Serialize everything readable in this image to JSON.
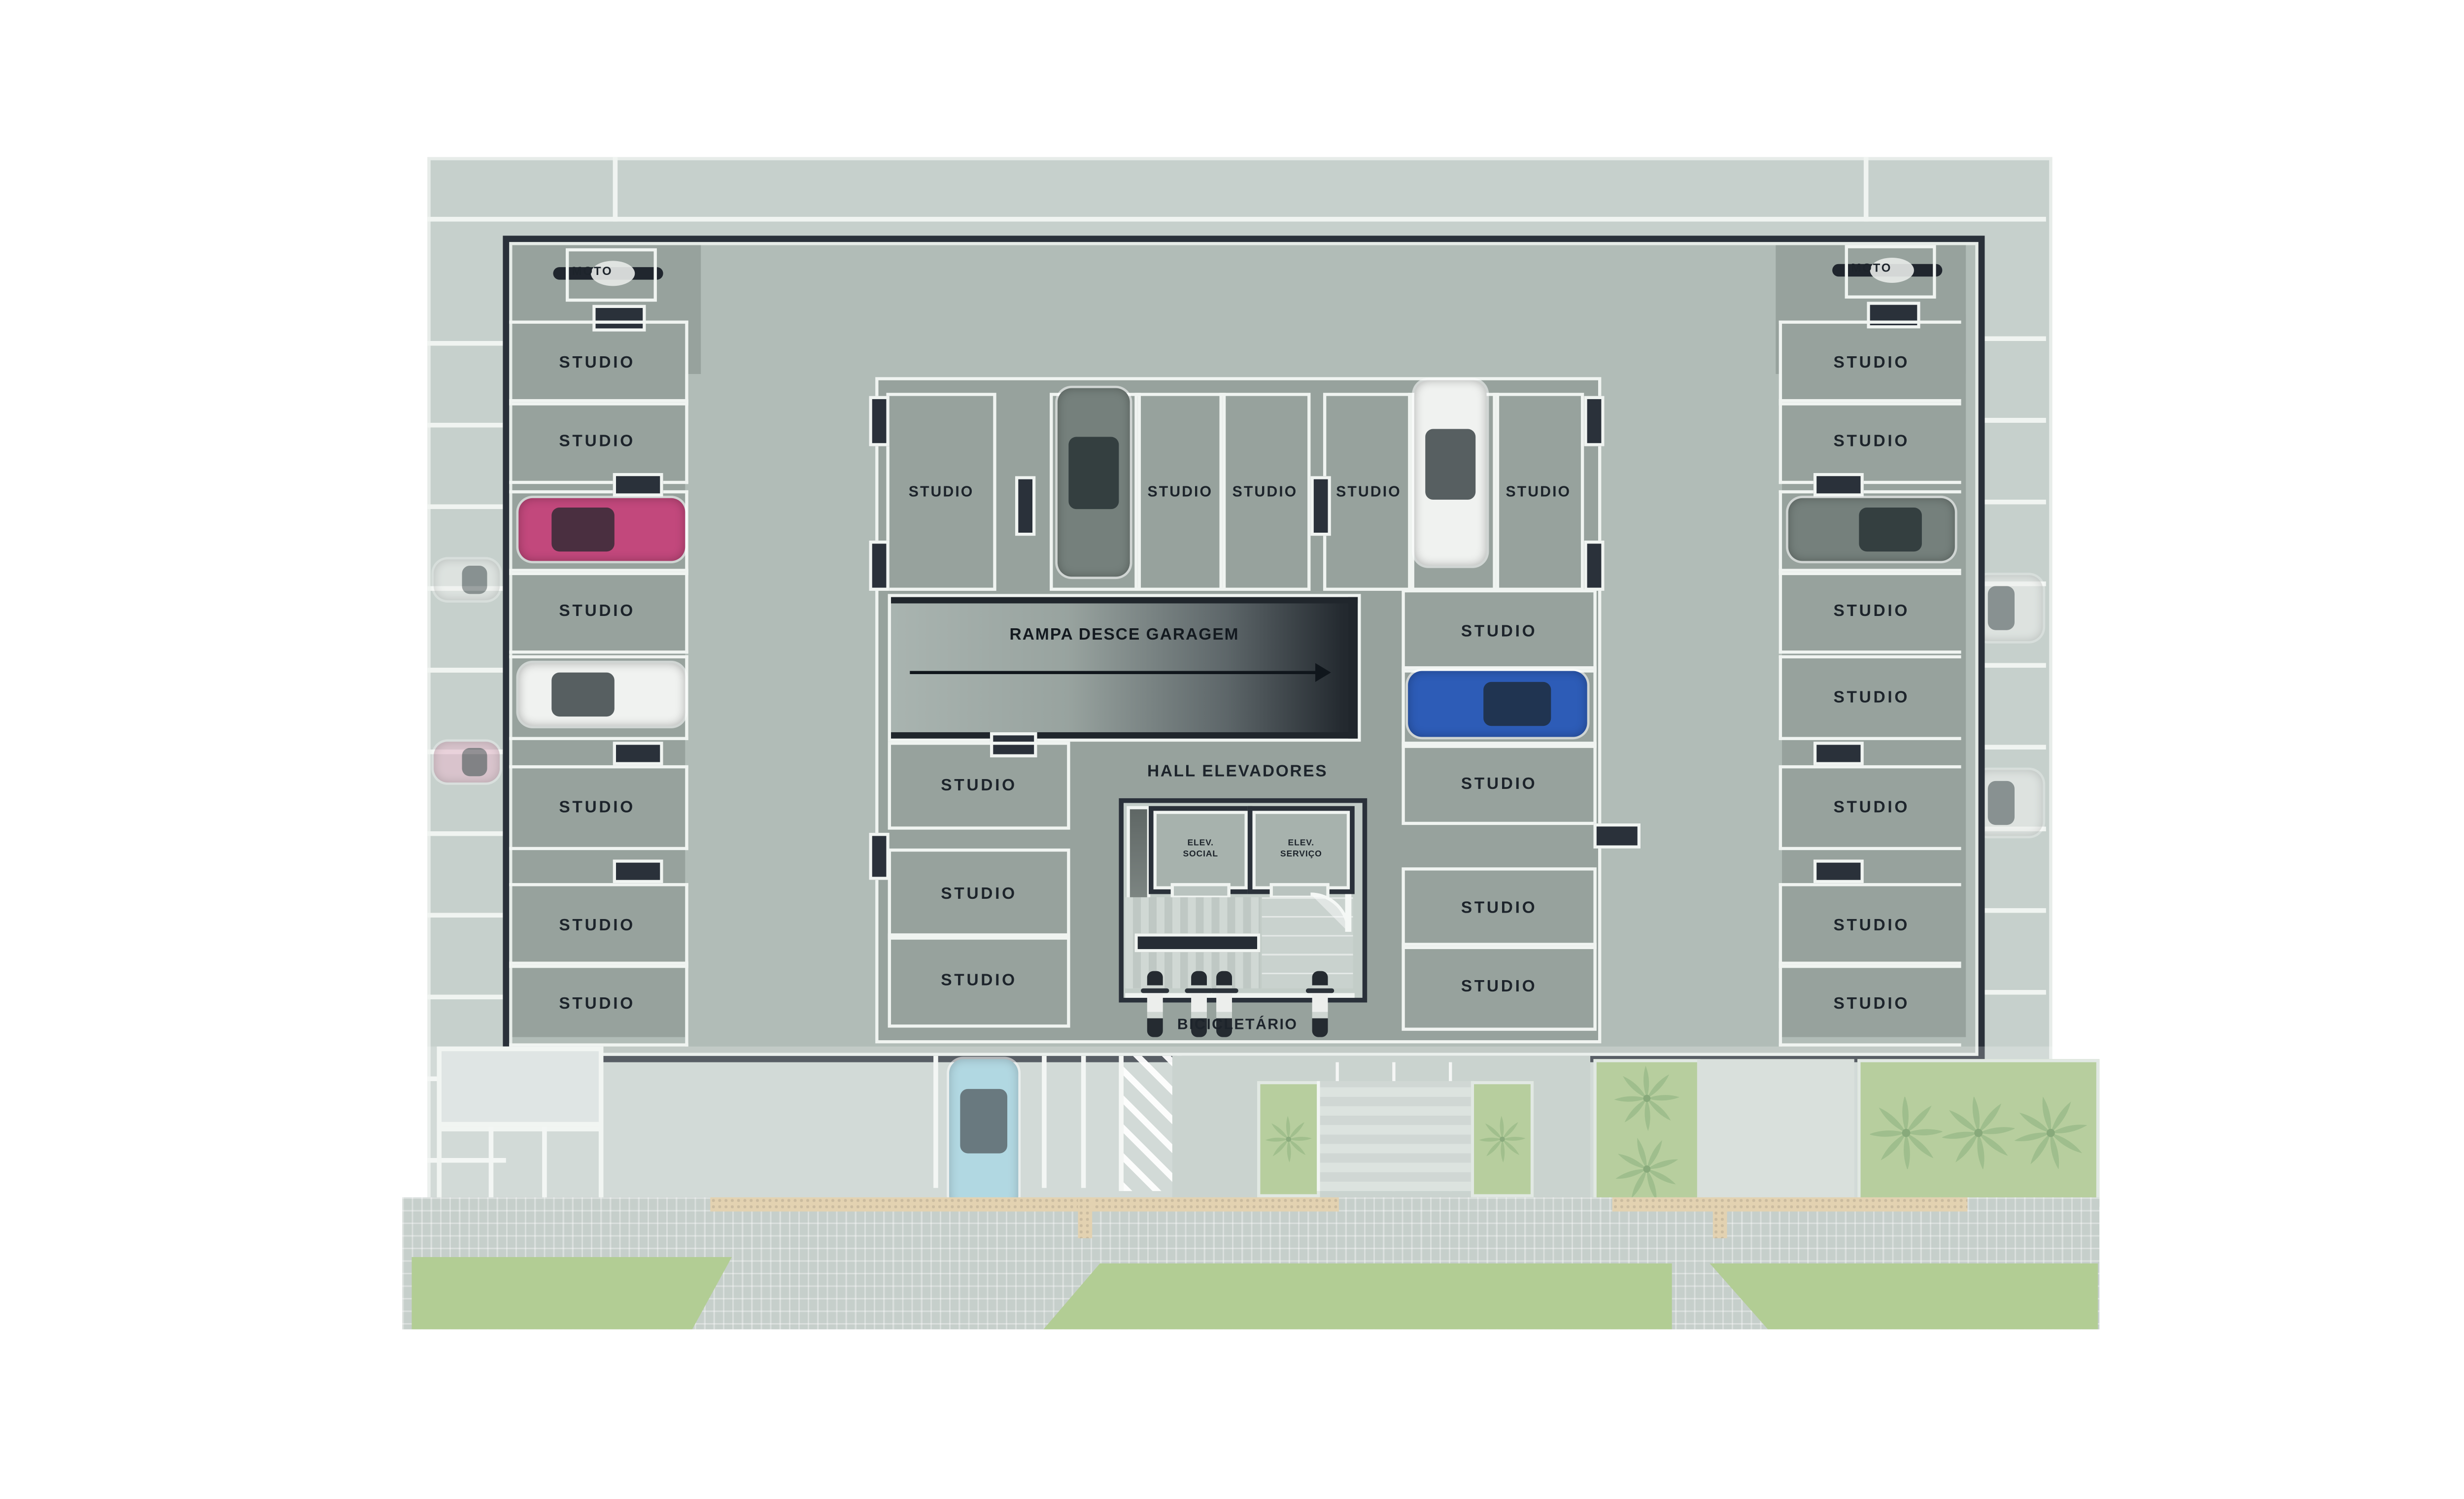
{
  "left_column": {
    "moto": "MOTO",
    "spaces": [
      "STUDIO",
      "STUDIO",
      "STUDIO",
      "STUDIO",
      "STUDIO",
      "STUDIO",
      "STUDIO",
      "STUDIO"
    ]
  },
  "right_column": {
    "moto": "MOTO",
    "spaces": [
      "STUDIO",
      "STUDIO",
      "STUDIO",
      "STUDIO",
      "STUDIO",
      "STUDIO",
      "STUDIO",
      "STUDIO"
    ]
  },
  "island": {
    "top_row": [
      "STUDIO",
      "STUDIO",
      "STUDIO",
      "STUDIO",
      "STUDIO",
      "STUDIO",
      "STUDIO"
    ],
    "ramp_label": "RAMPA DESCE GARAGEM",
    "hall_label": "HALL ELEVADORES",
    "elevators": [
      {
        "line1": "ELEV.",
        "line2": "SOCIAL"
      },
      {
        "line1": "ELEV.",
        "line2": "SERVIÇO"
      }
    ],
    "left_spaces": [
      "STUDIO",
      "STUDIO",
      "STUDIO"
    ],
    "right_spaces": [
      "STUDIO",
      "STUDIO",
      "STUDIO",
      "STUDIO",
      "STUDIO"
    ],
    "bike_label": "BICICLETÁRIO"
  },
  "colors": {
    "wall": "#2a313a",
    "floor_dark": "#97a29d",
    "floor_light": "#b1bcb7",
    "overlay": "#c6d0cc",
    "marking": "#f0f4f1",
    "text": "#1d242b",
    "car_pink": "#c2487c",
    "car_white": "#f0f2f0",
    "car_gray": "#75807c",
    "car_blue": "#2d5cb7",
    "car_lightblue": "#9ccdda",
    "car_faint_pink": "#e6bccd",
    "green": "#9dbf77",
    "tactile": "#dcc69c"
  }
}
